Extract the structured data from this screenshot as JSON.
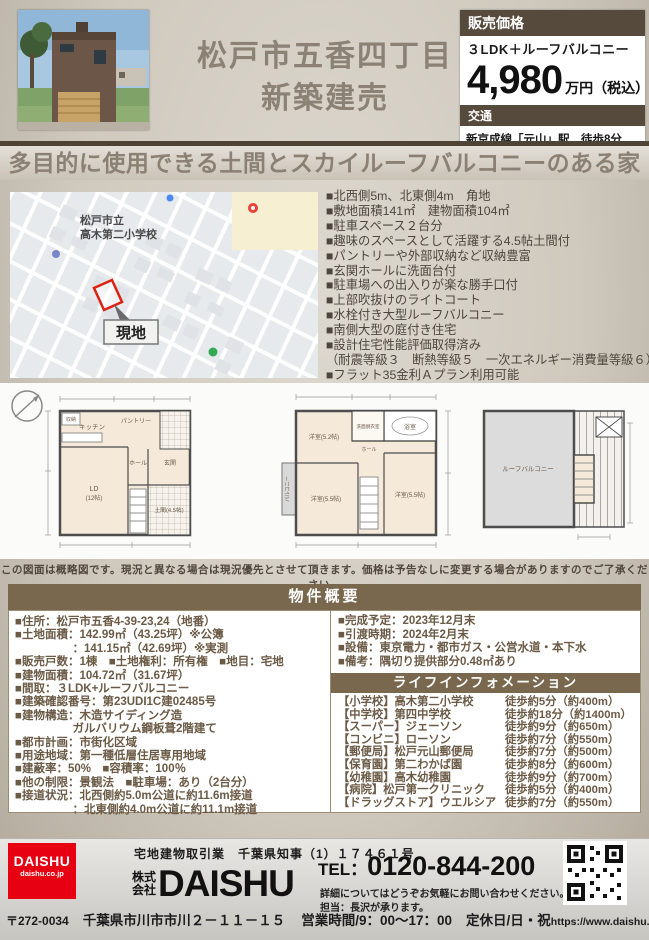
{
  "colors": {
    "brand_brown": "#79684e",
    "dark_brown": "#564a3c",
    "logo_red": "#e60012"
  },
  "header": {
    "title_line1": "松戸市五香四丁目",
    "title_line2": "新築建売",
    "price": {
      "label": "販売価格",
      "plan": "３LDK＋ルーフバルコニー",
      "value": "4,980",
      "unit": "万円（税込）",
      "access_label": "交通",
      "access": "新京成線「元山」駅　徒歩8分"
    }
  },
  "banner": "多目的に使用できる土間とスカイルーフバルコニーのある家",
  "map": {
    "school_line1": "松戸市立",
    "school_line2": "高木第二小学校",
    "site_label": "現地"
  },
  "features": [
    "■北西側5m、北東側4m　角地",
    "■敷地面積141㎡　建物面積104㎡",
    "■駐車スペース２台分",
    "■趣味のスペースとして活躍する4.5帖土間付",
    "■パントリーや外部収納など収納豊富",
    "■玄関ホールに洗面台付",
    "■駐車場への出入りが楽な勝手口付",
    "■上部吹抜けのライトコート",
    "■水栓付き大型ルーフバルコニー",
    "■南側大型の庭付き住宅",
    "■設計住宅性能評価取得済み",
    "（耐震等級３　断熱等級５　一次エネルギー消費量等級６）",
    "■フラット35金利Ａプラン利用可能"
  ],
  "plans": {
    "floor1": {
      "ld": "LD",
      "ld_size": "(12帖)",
      "kitchen": "キッチン",
      "pantry": "パントリー",
      "hall": "ホール",
      "entrance": "玄関",
      "doma": "土間(4.5帖)",
      "closet": "収納"
    },
    "floor2": {
      "room1": "洋室(5.2帖)",
      "room2": "洋室(5.5帖)",
      "room3": "洋室(5.5帖)",
      "balcony": "バルコニー",
      "bath": "浴室",
      "wash": "洗面脱衣室",
      "hall": "ホール"
    },
    "roof": {
      "roof_balcony": "ルーフバルコニー"
    },
    "disclaimer": "この図面は概略図です。現況と異なる場合は現況優先とさせて頂きます。価格は予告なしに変更する場合がありますのでご了承ください。"
  },
  "overview": {
    "heading": "物件概要",
    "left": [
      "■住所：松戸市五香4-39-23,24（地番）",
      "■土地面積：142.99㎡（43.25坪）※公簿",
      "　　　　　：141.15㎡（42.69坪）※実測",
      "■販売戸数：1棟　■土地権利：所有権　■地目：宅地",
      "■建物面積：104.72㎡（31.67坪）",
      "■間取：３LDK+ルーフバルコニー",
      "■建築確認番号：第23UDI1C建02485号",
      "■建物構造：木造サイディング造",
      "　　　　　ガルバリウム鋼板葺2階建て",
      "■都市計画：市街化区域",
      "■用途地域：第一種低層住居専用地域",
      "■建蔽率：50%　■容積率：100％",
      "■他の制限：景観法　■駐車場：あり（2台分）",
      "■接道状況：北西側約5.0m公道に約11.6m接道",
      "　　　　　：北東側約4.0m公道に約11.1m接道"
    ],
    "right": [
      "■完成予定：2023年12月末",
      "■引渡時期：2024年2月末",
      "■設備：東京電力・都市ガス・公営水道・本下水",
      "■備考：隅切り提供部分0.48㎡あり"
    ],
    "life_info": {
      "heading": "ライフインフォメーション",
      "items": [
        {
          "place": "【小学校】高木第二小学校",
          "distance": "徒歩約5分（約400m）"
        },
        {
          "place": "【中学校】第四中学校",
          "distance": "徒歩約18分（約1400m）"
        },
        {
          "place": "【スーパー】ジェーソン",
          "distance": "徒歩約9分（約650m）"
        },
        {
          "place": "【コンビニ】ローソン",
          "distance": "徒歩約7分（約550m）"
        },
        {
          "place": "【郵便局】松戸元山郵便局",
          "distance": "徒歩約7分（約500m）"
        },
        {
          "place": "【保育園】第二わかば園",
          "distance": "徒歩約8分（約600m）"
        },
        {
          "place": "【幼稚園】高木幼稚園",
          "distance": "徒歩約9分（約700m）"
        },
        {
          "place": "【病院】松戸第一クリニック",
          "distance": "徒歩約5分（約400m）"
        },
        {
          "place": "【ドラッグストア】ウエルシア",
          "distance": "徒歩約7分（約550m）"
        }
      ]
    }
  },
  "footer": {
    "logo_text": "DAISHU",
    "logo_sub": "daishu.co.jp",
    "license": "宅地建物取引業　千葉県知事（1）１７４６１号",
    "company_prefix": "株式会社",
    "company_name": "DAISHU",
    "tel_prefix": "TEL：",
    "tel_number": "0120-844-200",
    "note1": "詳細についてはどうぞお気軽にお問い合わせください。",
    "note2": "担当：長沢が承ります。",
    "postal": "〒272-0034",
    "address": "千葉県市川市市川２－１１－１５",
    "hours": "営業時間/9：00～17：00",
    "closed": "定休日/日・祝",
    "url": "https://www.daishu.co.jp/"
  }
}
